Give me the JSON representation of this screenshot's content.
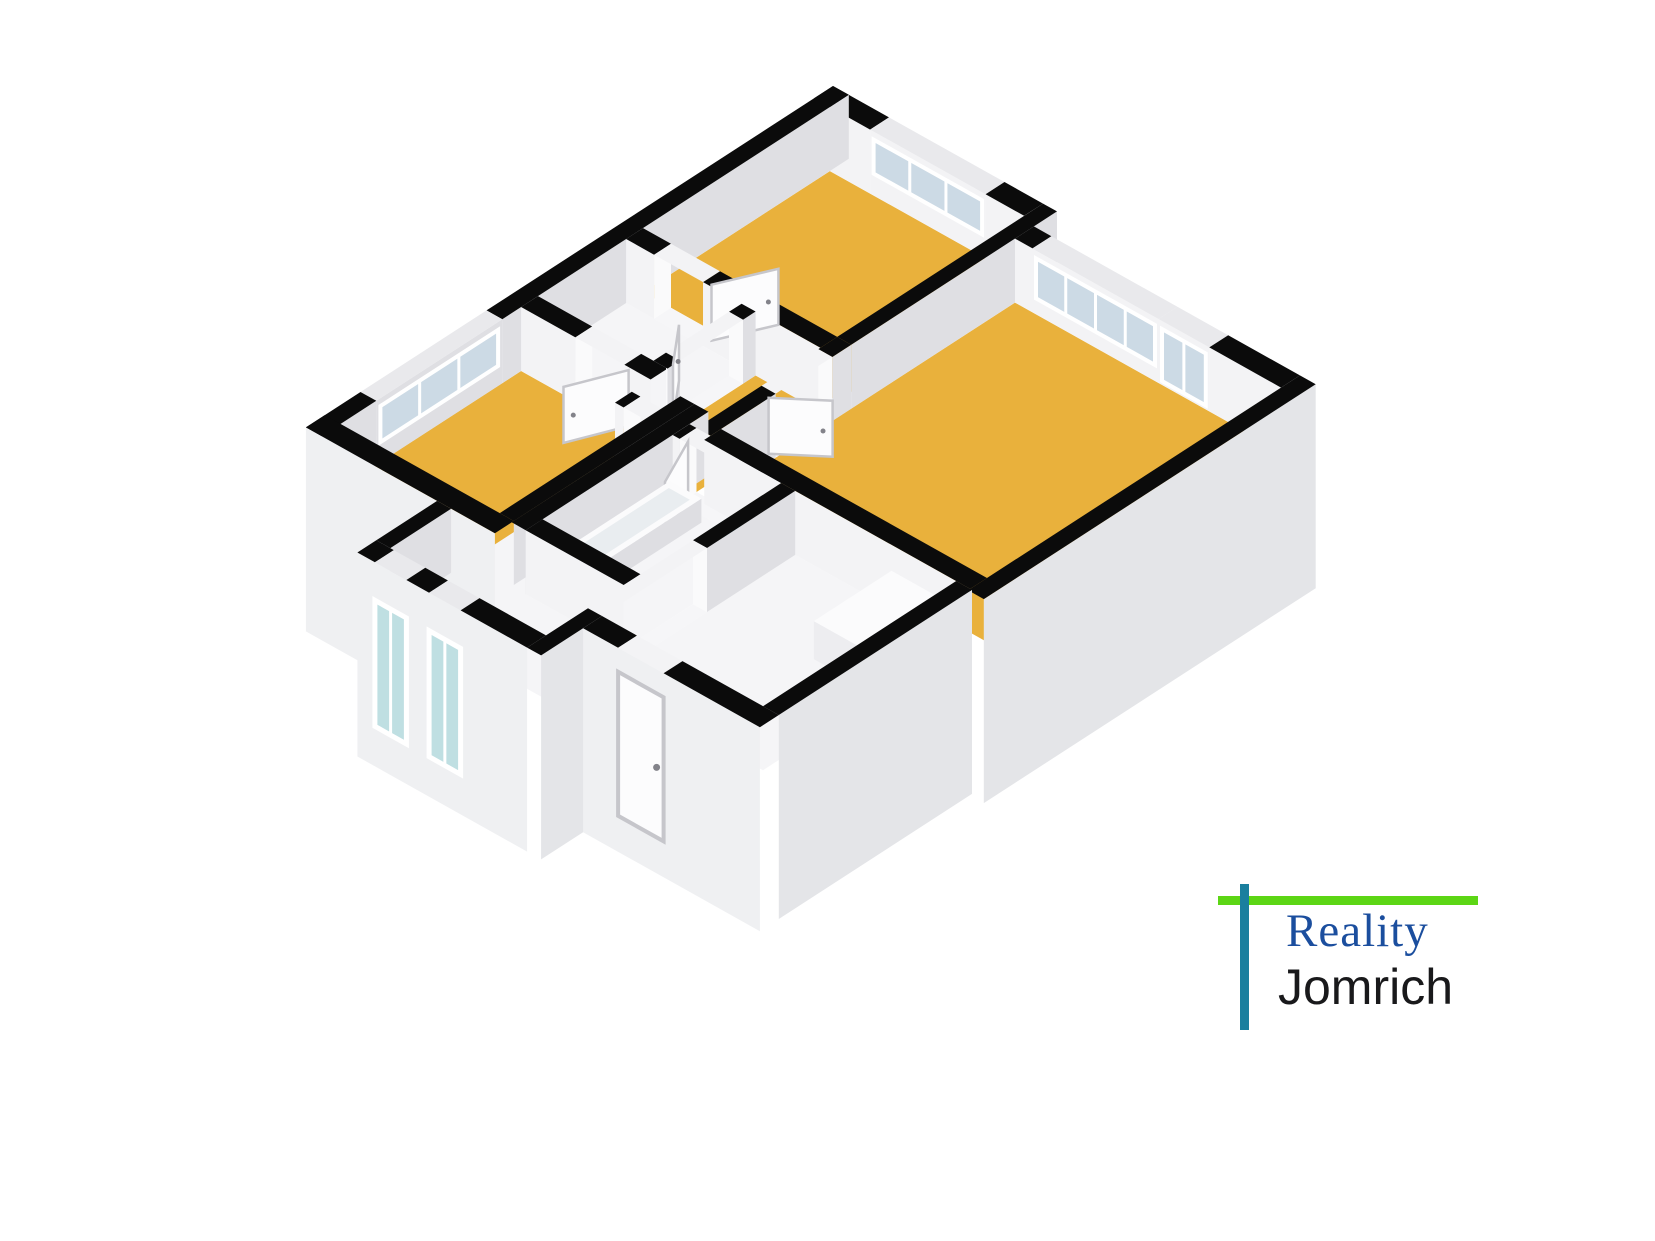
{
  "canvas": {
    "width": 1655,
    "height": 1241,
    "background": "#ffffff"
  },
  "logo": {
    "title": "Reality",
    "subtitle": "Jomrich",
    "title_color": "#1b4e9e",
    "subtitle_color": "#19191b",
    "green_line_color": "#5cd615",
    "teal_line_color": "#1a7f9e"
  },
  "palette": {
    "capDark": "#0b0b0b",
    "capLight": "#e9e9ec",
    "capDoor": "#f3f3f5",
    "faceS": "#f3f3f5",
    "faceE": "#dfdfe3",
    "jamb": "#fafafb",
    "thresh": "#f6f6f8",
    "skirt": "#eff0f2",
    "skirtE": "#e4e5e8",
    "glass": "#ccdae5",
    "glassTeal": "#bfdfe2",
    "frame": "#ffffff",
    "leaf": "#fcfcfd",
    "leafEdge": "#c6c6cb",
    "orange": "#e9b13c",
    "white": "#f5f5f7",
    "handle": "#83838a",
    "tubInner": "#e9edf0",
    "basinTop": "#8fd0da",
    "boxTop": "#fbfbfc",
    "boxFaceS": "#ededf0",
    "boxFaceE": "#dedee2"
  },
  "floorplan": {
    "ox": 833,
    "oy": 150,
    "wall_height": 64,
    "skirt_depth": 140,
    "proj": {
      "ax": 0.875,
      "ay": 0.49,
      "bx": 1.05,
      "by": 0.68
    },
    "floors": [
      {
        "n": "floor-bedroom-1",
        "c": "orange",
        "pts": [
          [
            18,
            18
          ],
          [
            240,
            18
          ],
          [
            240,
            196
          ],
          [
            18,
            196
          ]
        ]
      },
      {
        "n": "floor-living-room",
        "c": "orange",
        "pts": [
          [
            256,
            40
          ],
          [
            560,
            40
          ],
          [
            560,
            320
          ],
          [
            256,
            320
          ]
        ]
      },
      {
        "n": "floor-vestibule",
        "c": "white",
        "pts": [
          [
            18,
            212
          ],
          [
            150,
            212
          ],
          [
            150,
            296
          ],
          [
            18,
            296
          ]
        ]
      },
      {
        "n": "floor-bedroom-2",
        "c": "orange",
        "pts": [
          [
            18,
            312
          ],
          [
            200,
            312
          ],
          [
            200,
            484
          ],
          [
            18,
            484
          ]
        ]
      },
      {
        "n": "floor-hall",
        "c": "orange",
        "pts": [
          [
            166,
            212
          ],
          [
            240,
            212
          ],
          [
            240,
            330
          ],
          [
            166,
            330
          ]
        ]
      },
      {
        "n": "floor-bathroom",
        "c": "white",
        "pts": [
          [
            232,
            346
          ],
          [
            344,
            346
          ],
          [
            344,
            470
          ],
          [
            232,
            470
          ]
        ]
      },
      {
        "n": "floor-corridor",
        "c": "white",
        "pts": [
          [
            166,
            346
          ],
          [
            232,
            346
          ],
          [
            232,
            486
          ],
          [
            344,
            486
          ],
          [
            344,
            560
          ],
          [
            166,
            560
          ]
        ]
      },
      {
        "n": "floor-kitchen",
        "c": "white",
        "pts": [
          [
            360,
            336
          ],
          [
            544,
            336
          ],
          [
            544,
            520
          ],
          [
            360,
            520
          ]
        ]
      }
    ],
    "walls": [
      {
        "n": "wall-bedroom1-ne",
        "axis": "a",
        "a0": 0,
        "a1": 240,
        "b0": 0,
        "b1": 18,
        "k": 129,
        "kind": "in",
        "spans": [
          {
            "t": "s",
            "f": 0,
            "to": 64
          },
          {
            "t": "w",
            "f": 64,
            "to": 196,
            "sill": 22
          },
          {
            "t": "s",
            "f": 196,
            "to": 240
          }
        ]
      },
      {
        "n": "wall-nw-outer",
        "axis": "b",
        "a0": 0,
        "a1": 18,
        "b0": 0,
        "b1": 502,
        "k": 260,
        "kind": "in",
        "spans": [
          {
            "t": "s",
            "f": 0,
            "to": 330
          },
          {
            "t": "w",
            "f": 330,
            "to": 450,
            "sill": 20
          },
          {
            "t": "s",
            "f": 450,
            "to": 502
          }
        ]
      },
      {
        "n": "wall-bedroom1-sw",
        "axis": "a",
        "a0": 18,
        "a1": 240,
        "b0": 196,
        "b1": 212,
        "k": 333,
        "kind": "in",
        "spans": [
          {
            "t": "s",
            "f": 18,
            "to": 50
          },
          {
            "t": "d",
            "f": 50,
            "to": 106
          },
          {
            "t": "s",
            "f": 106,
            "to": 240
          }
        ]
      },
      {
        "n": "wall-bedroom1-living",
        "axis": "b",
        "a0": 240,
        "a1": 256,
        "b0": 0,
        "b1": 196,
        "k": 346,
        "kind": "in",
        "spans": [
          {
            "t": "s",
            "f": 0,
            "to": 196
          }
        ]
      },
      {
        "n": "wall-vestibule-bedroom2",
        "axis": "a",
        "a0": 18,
        "a1": 166,
        "b0": 296,
        "b1": 312,
        "k": 396,
        "kind": "in",
        "spans": [
          {
            "t": "s",
            "f": 18,
            "to": 80
          },
          {
            "t": "d",
            "f": 80,
            "to": 136
          },
          {
            "t": "s",
            "f": 136,
            "to": 166
          }
        ]
      },
      {
        "n": "wall-vestibule-hall",
        "axis": "b",
        "a0": 150,
        "a1": 166,
        "b0": 212,
        "b1": 296,
        "k": 412,
        "kind": "in",
        "spans": [
          {
            "t": "s",
            "f": 212,
            "to": 224
          },
          {
            "t": "d",
            "f": 224,
            "to": 284
          },
          {
            "t": "s",
            "f": 284,
            "to": 296
          }
        ]
      },
      {
        "n": "wall-living-ne",
        "axis": "a",
        "a0": 256,
        "a1": 560,
        "b0": 22,
        "b1": 40,
        "k": 440,
        "kind": "in",
        "spans": [
          {
            "t": "s",
            "f": 256,
            "to": 276
          },
          {
            "t": "w",
            "f": 276,
            "to": 420,
            "sill": 16
          },
          {
            "t": "w",
            "f": 420,
            "to": 478,
            "sill": 4
          },
          {
            "t": "s",
            "f": 478,
            "to": 560
          }
        ]
      },
      {
        "n": "wall-hall-living",
        "axis": "b",
        "a0": 240,
        "a1": 256,
        "b0": 196,
        "b1": 330,
        "k": 511,
        "kind": "in",
        "spans": [
          {
            "t": "s",
            "f": 196,
            "to": 214
          },
          {
            "t": "d",
            "f": 214,
            "to": 268
          },
          {
            "t": "s",
            "f": 268,
            "to": 330
          }
        ]
      },
      {
        "n": "wall-hall-corridor",
        "axis": "a",
        "a0": 166,
        "a1": 232,
        "b0": 330,
        "b1": 346,
        "k": 537,
        "kind": "in",
        "spans": [
          {
            "t": "s",
            "f": 166,
            "to": 176
          },
          {
            "t": "d",
            "f": 176,
            "to": 220
          },
          {
            "t": "s",
            "f": 220,
            "to": 232
          }
        ]
      },
      {
        "n": "wall-bedroom2-sw-outer",
        "axis": "a",
        "a0": 0,
        "a1": 216,
        "b0": 484,
        "b1": 502,
        "k": 601,
        "kind": "out",
        "spans": [
          {
            "t": "s",
            "f": 0,
            "to": 216
          }
        ]
      },
      {
        "n": "wall-bedroom2-hall",
        "axis": "b",
        "a0": 200,
        "a1": 216,
        "b0": 312,
        "b1": 484,
        "k": 606,
        "kind": "in",
        "spans": [
          {
            "t": "s",
            "f": 312,
            "to": 484
          }
        ]
      },
      {
        "n": "wall-bath-west",
        "axis": "b",
        "a0": 216,
        "a1": 232,
        "b0": 312,
        "b1": 486,
        "k": 623,
        "kind": "in",
        "spans": [
          {
            "t": "s",
            "f": 312,
            "to": 486
          }
        ]
      },
      {
        "n": "wall-bath-north",
        "axis": "a",
        "a0": 232,
        "a1": 344,
        "b0": 330,
        "b1": 346,
        "k": 626,
        "kind": "in",
        "spans": [
          {
            "t": "s",
            "f": 232,
            "to": 240
          },
          {
            "t": "d",
            "f": 240,
            "to": 296
          },
          {
            "t": "s",
            "f": 296,
            "to": 344
          }
        ]
      },
      {
        "n": "wall-corridor-west-outer",
        "axis": "b",
        "a0": 150,
        "a1": 166,
        "b0": 502,
        "b1": 560,
        "k": 689,
        "kind": "in",
        "spans": [
          {
            "t": "s",
            "f": 502,
            "to": 560
          }
        ]
      },
      {
        "n": "wall-living-sw",
        "axis": "a",
        "a0": 256,
        "a1": 560,
        "b0": 320,
        "b1": 336,
        "k": 737,
        "kind": "in",
        "spans": [
          {
            "t": "s",
            "f": 256,
            "to": 560
          }
        ]
      },
      {
        "n": "wall-living-se-outer",
        "axis": "b",
        "a0": 560,
        "a1": 578,
        "b0": 22,
        "b1": 338,
        "k": 749,
        "kind": "out",
        "spans": [
          {
            "t": "s",
            "f": 22,
            "to": 338
          }
        ]
      },
      {
        "n": "wall-bath-south",
        "axis": "a",
        "a0": 232,
        "a1": 344,
        "b0": 470,
        "b1": 486,
        "k": 766,
        "kind": "in",
        "spans": [
          {
            "t": "s",
            "f": 232,
            "to": 344
          }
        ]
      },
      {
        "n": "wall-bath-kitchen",
        "axis": "b",
        "a0": 344,
        "a1": 360,
        "b0": 336,
        "b1": 520,
        "k": 780,
        "kind": "in",
        "spans": [
          {
            "t": "s",
            "f": 336,
            "to": 420
          },
          {
            "t": "d",
            "f": 420,
            "to": 520
          }
        ]
      },
      {
        "n": "wall-sw-outer-windows",
        "axis": "a",
        "a0": 150,
        "a1": 344,
        "b0": 560,
        "b1": 578,
        "k": 816,
        "kind": "out",
        "spans": [
          {
            "t": "s",
            "f": 150,
            "to": 170
          },
          {
            "t": "w",
            "f": 170,
            "to": 206
          },
          {
            "t": "s",
            "f": 206,
            "to": 232
          },
          {
            "t": "w",
            "f": 232,
            "to": 268
          },
          {
            "t": "s",
            "f": 268,
            "to": 344
          }
        ],
        "skirtWin": [
          [
            170,
            206
          ],
          [
            232,
            268
          ]
        ]
      },
      {
        "n": "wall-kitchen-jog-outer",
        "axis": "b",
        "a0": 344,
        "a1": 360,
        "b0": 520,
        "b1": 578,
        "k": 901,
        "kind": "out",
        "spans": [
          {
            "t": "s",
            "f": 520,
            "to": 578
          }
        ]
      },
      {
        "n": "wall-kitchen-se-outer",
        "axis": "b",
        "a0": 544,
        "a1": 562,
        "b0": 336,
        "b1": 520,
        "k": 981,
        "kind": "out",
        "spans": [
          {
            "t": "s",
            "f": 336,
            "to": 520
          }
        ]
      },
      {
        "n": "wall-kitchen-s-outer",
        "axis": "a",
        "a0": 360,
        "a1": 562,
        "b0": 520,
        "b1": 538,
        "k": 990,
        "kind": "out",
        "spans": [
          {
            "t": "s",
            "f": 360,
            "to": 400
          },
          {
            "t": "d",
            "f": 400,
            "to": 452
          },
          {
            "t": "s",
            "f": 452,
            "to": 562
          }
        ],
        "skirtDoor": [
          400,
          452
        ]
      }
    ],
    "objects": [
      {
        "n": "bathtub",
        "a0": 236,
        "a1": 272,
        "b0": 352,
        "b1": 464,
        "h": 24,
        "top": "boxTop",
        "inner": "tubInner",
        "k": 662
      },
      {
        "n": "washbasin",
        "a0": 312,
        "a1": 340,
        "b0": 350,
        "b1": 378,
        "h": 30,
        "top": "basinTop",
        "k": 690
      },
      {
        "n": "kitchen-counter",
        "a0": 470,
        "a1": 544,
        "b0": 336,
        "b1": 410,
        "h": 38,
        "top": "boxTop",
        "k": 880
      }
    ],
    "door_leaves": [
      {
        "n": "door-leaf-bedroom-1",
        "p0": [
          106,
          204
        ],
        "p1": [
          132,
          162
        ],
        "h": 56,
        "k": 335
      },
      {
        "n": "door-leaf-bedroom-2",
        "p0": [
          136,
          308
        ],
        "p1": [
          112,
          350
        ],
        "h": 56,
        "k": 398
      },
      {
        "n": "door-leaf-vestibule",
        "p0": [
          158,
          284
        ],
        "p1": [
          124,
          250
        ],
        "h": 56,
        "k": 414
      },
      {
        "n": "door-leaf-living-room",
        "p0": [
          248,
          268
        ],
        "p1": [
          290,
          242
        ],
        "h": 56,
        "k": 513
      },
      {
        "n": "door-leaf-bathroom",
        "p0": [
          240,
          338
        ],
        "p1": [
          264,
          380
        ],
        "h": 56,
        "k": 628
      }
    ]
  }
}
